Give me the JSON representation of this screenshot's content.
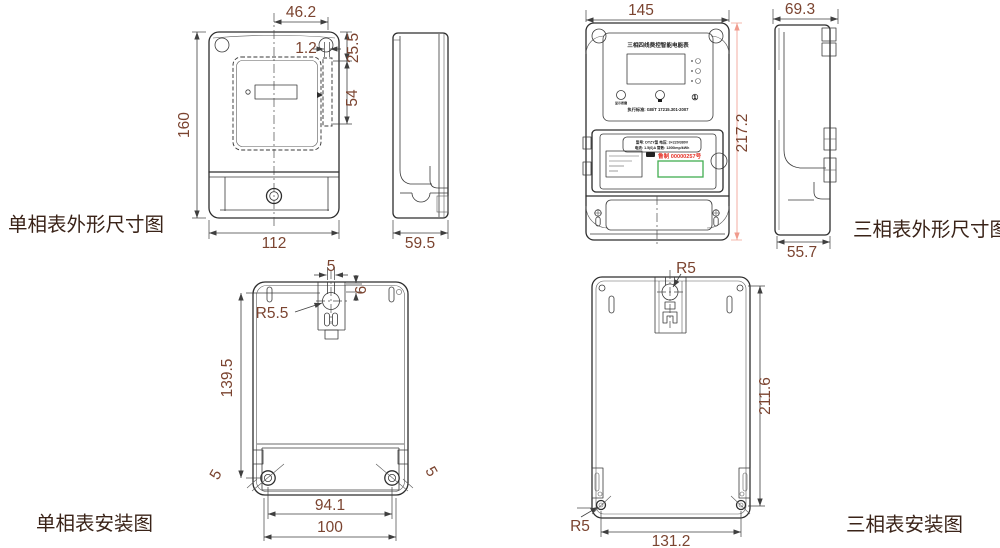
{
  "captions": {
    "sp_outline": "单相表外形尺寸图",
    "tp_outline": "三相表外形尺寸图",
    "sp_install": "单相表安装图",
    "tp_install": "三相表安装图"
  },
  "sp_front": {
    "top_width": "46.2",
    "gap": "1.2",
    "upper_height": "25.5",
    "seal_height": "54",
    "height": "160",
    "width": "112"
  },
  "sp_side": {
    "depth": "59.5"
  },
  "tp_front": {
    "width": "145",
    "height": "217.2",
    "title": "三相四线费控智能电能表",
    "standard": "执行标准: GB/T 17215.301-2007",
    "spec_line1": "型号: DTZY型  电压: 3×220/380V",
    "spec_line2": "电流: 1.5(6)A  常数: 1200imp/kWh",
    "approval": "鲁制 00000257号",
    "class_mark": "①",
    "button1_label": "显示按键"
  },
  "tp_side": {
    "depth_top": "69.3",
    "depth_bottom": "55.7"
  },
  "sp_install": {
    "slot_width": "5",
    "slot_offset": "6",
    "radius": "R5.5",
    "height": "139.5",
    "hole_left": "5",
    "hole_right": "5",
    "hole_span": "94.1",
    "width": "100"
  },
  "tp_install": {
    "radius_top": "R5",
    "height": "211.6",
    "radius_bottom": "R5",
    "width": "131.2"
  },
  "colors": {
    "dim_text": "#7b4430",
    "caption_text": "#3a2318",
    "outline": "#2d2d2d",
    "height_dim_line": "#f09a8c",
    "approval_red": "#e53228",
    "barcode_green": "#42ae50"
  }
}
